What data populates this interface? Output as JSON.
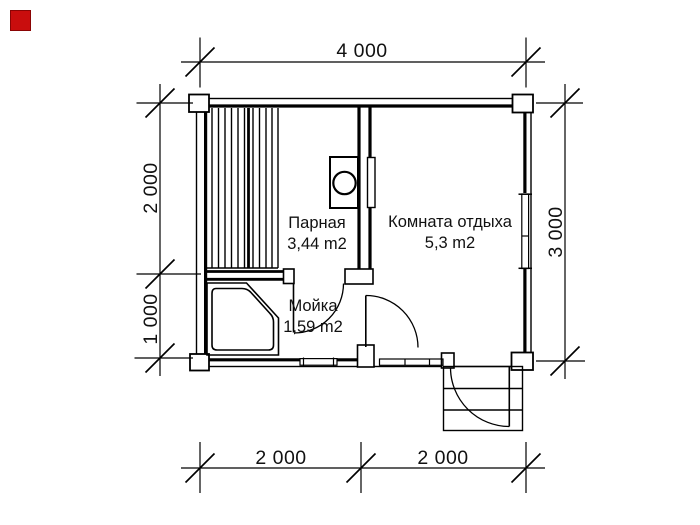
{
  "logo": {
    "color": "#c90d0d"
  },
  "plan": {
    "rooms": [
      {
        "id": "steam-room",
        "name": "Парная",
        "area": "3,44 m2"
      },
      {
        "id": "rest-room",
        "name": "Комната отдыха",
        "area": "5,3 m2"
      },
      {
        "id": "wash-room",
        "name": "Мойка",
        "area": "1,59 m2"
      }
    ],
    "dimensions": {
      "top": "4 000",
      "left_upper": "2 000",
      "left_lower": "1 000",
      "right": "3 000",
      "bottom_left": "2 000",
      "bottom_right": "2 000"
    }
  },
  "colors": {
    "line": "#000000",
    "background": "#ffffff"
  }
}
